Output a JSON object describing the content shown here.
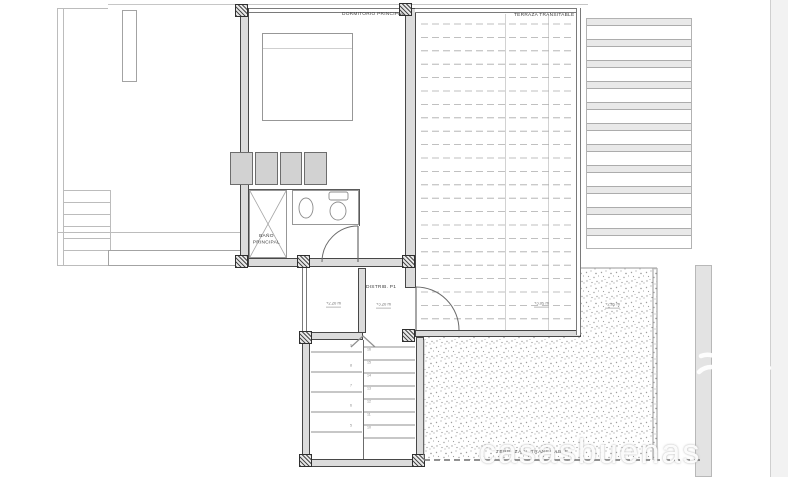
{
  "rooms": {
    "dormitorio_principal": "DORMITORIO PRINCIPAL",
    "terraza_transitable": "TERRAZA TRANSITABLE",
    "bano_principal": "BAÑO PRINCIPAL",
    "distribuidor": "DISTRIB. P1",
    "terraza_no_transitable": "TERRAZA N. TRANSITABLE"
  },
  "levels": {
    "landing": "+2.20 m",
    "distribuidor": "+3.20 m",
    "terraza": "+3.05 m",
    "cubierta": "+2.85 m"
  },
  "stairs": {
    "left_step_numbers": [
      "9",
      "8",
      "7",
      "6",
      "5"
    ],
    "right_step_numbers": [
      "16",
      "15",
      "14",
      "13",
      "12",
      "11",
      "10"
    ]
  },
  "watermark": {
    "text": "casasbuenas",
    "logo": "palm-tree-icon"
  },
  "colors": {
    "wall": "#474747",
    "wall_fill": "#dcdcdc",
    "thin_line": "#bcbcbc",
    "deck_line": "#ababab",
    "stipple": "#9f9f9f",
    "band_fill": "#e9e9e9",
    "watermark": "#ffffff"
  }
}
